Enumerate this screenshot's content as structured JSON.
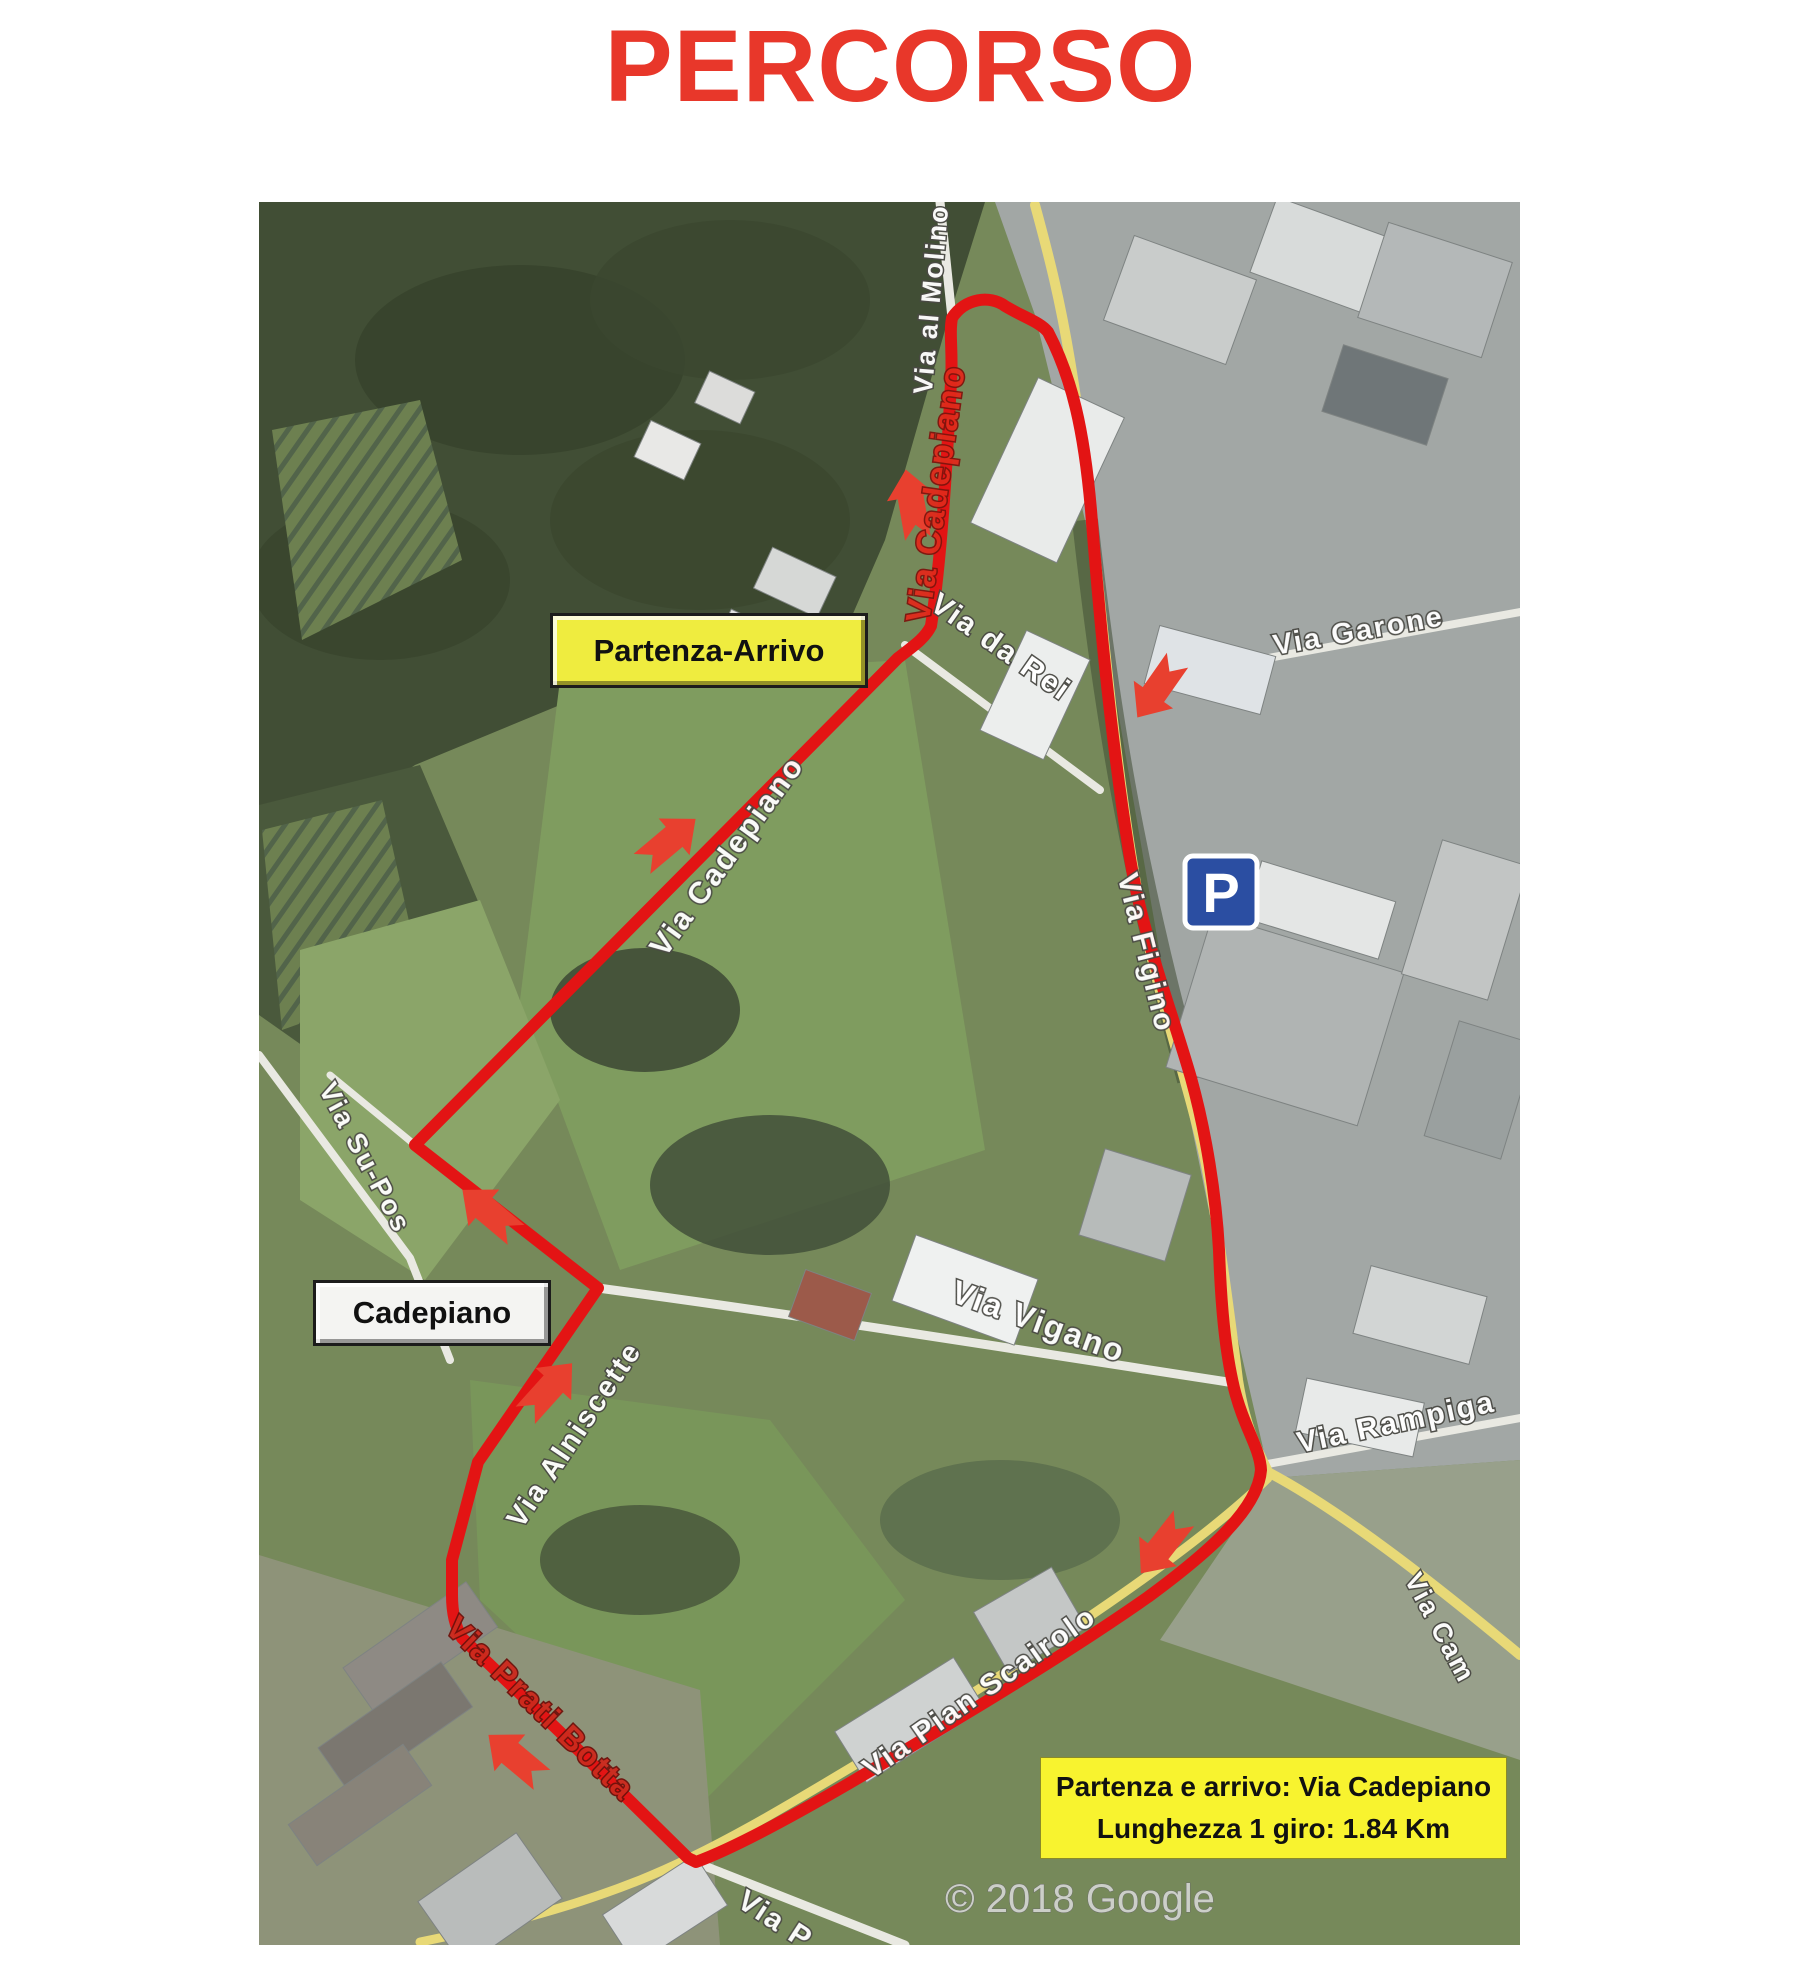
{
  "title": "PERCORSO",
  "map": {
    "attribution": "© 2018 Google",
    "parking_symbol": "P",
    "start_finish_label": "Partenza-Arrivo",
    "locality_label": "Cadepiano",
    "info_box": {
      "line1": "Partenza e arrivo: Via Cadepiano",
      "line2": "Lunghezza 1 giro: 1.84 Km"
    },
    "streets": {
      "al_molino": "Via al Molino",
      "cadepiano_upper": "Via Cadepiano",
      "cadepiano_lower": "Via Cadepiano",
      "da_rei": "Via da Rei",
      "garone": "Via Garone",
      "figino": "Via Figino",
      "vigano": "Via Vigano",
      "rampiga": "Via Rampiga",
      "su_pos": "Via Su-Pos",
      "alniscette": "Via Alniscette",
      "pian_scairolo": "Via Pian Scairolo",
      "prati_botta": "Via Prati Botta",
      "cam": "Via Cam",
      "partial_south": "Via P"
    },
    "colors": {
      "route_red": "#e31414",
      "title_red": "#e8372a",
      "label_yellow": "#efec3f",
      "info_yellow": "#f8f32f"
    }
  }
}
